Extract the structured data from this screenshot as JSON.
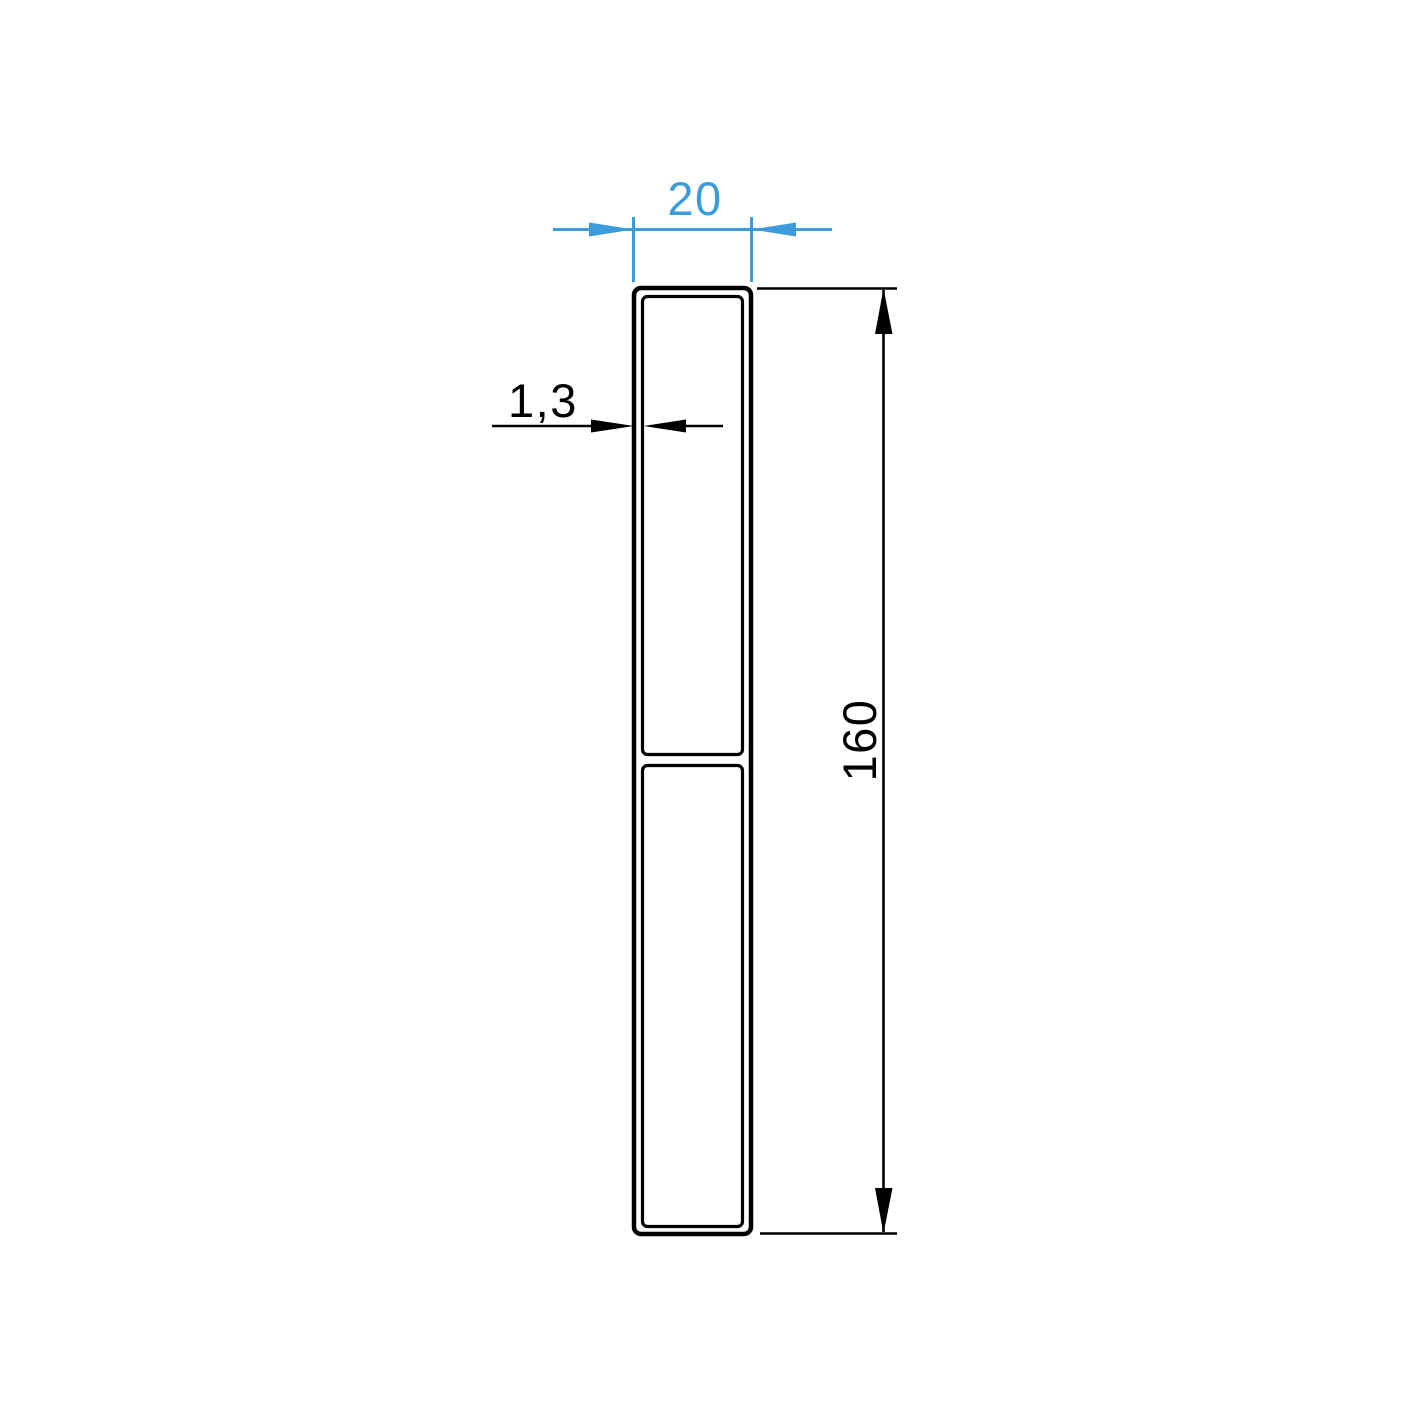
{
  "drawing": {
    "kind": "profile-cross-section-drawing",
    "background_color": "#ffffff",
    "outline_color": "#000000",
    "accent_color": "#3b9cd9",
    "dimensions": {
      "width": {
        "label": "20",
        "color": "#3b9cd9",
        "orientation": "horizontal-top"
      },
      "wall_thickness": {
        "label": "1,3",
        "color": "#000000",
        "orientation": "horizontal-left"
      },
      "height": {
        "label": "160",
        "color": "#000000",
        "orientation": "vertical-right"
      }
    }
  }
}
